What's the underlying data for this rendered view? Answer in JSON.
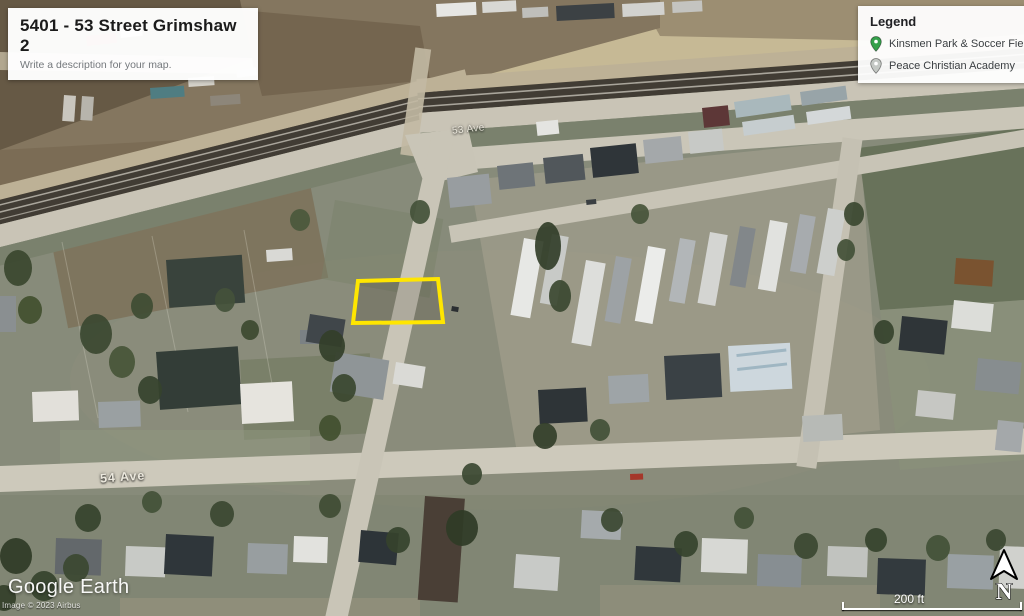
{
  "title_card": {
    "title": "5401 - 53 Street Grimshaw 2",
    "subtitle": "Write a description for your map."
  },
  "legend": {
    "title": "Legend",
    "items": [
      {
        "label": "Kinsmen Park & Soccer Field",
        "pin_color": "#35A04B"
      },
      {
        "label": "Peace Christian Academy",
        "pin_color": "#C4C8C4"
      }
    ]
  },
  "street_labels": {
    "ave53": "53 Ave",
    "ave54": "54 Ave"
  },
  "parcel": {
    "points": "358,281 438,279 443,322 353,323",
    "color": "#FFE600"
  },
  "watermark": {
    "brand": "Google Earth",
    "credit": "Image © 2023 Airbus"
  },
  "scale_bar": {
    "label": "200 ft"
  },
  "compass": {
    "label": "N"
  }
}
